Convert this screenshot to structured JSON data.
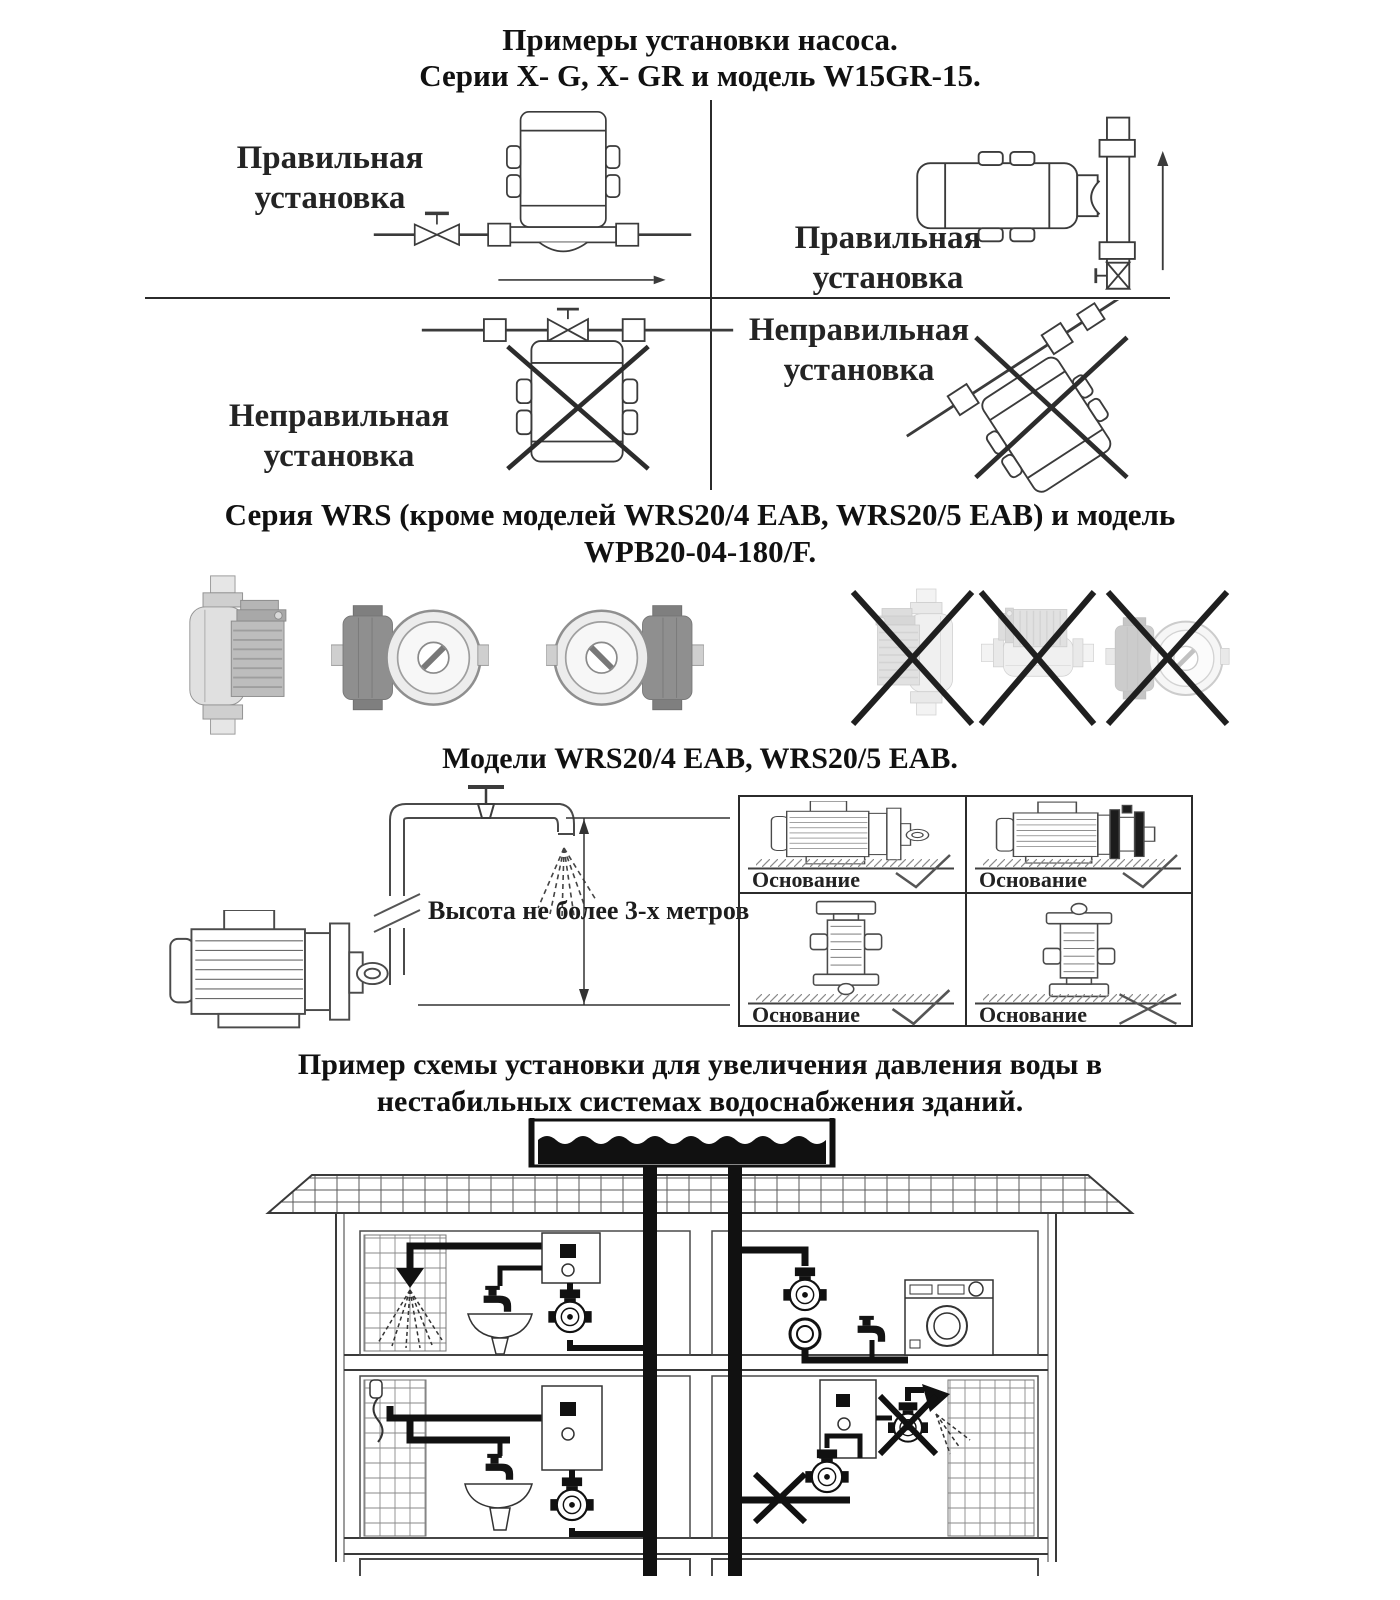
{
  "title": {
    "line1": "Примеры установки насоса.",
    "line2": "Серии X- G, X- GR и модель W15GR-15."
  },
  "xg_grid": {
    "top_left": {
      "label": "Правильная установка",
      "status": "correct"
    },
    "top_right": {
      "label": "Правильная установка",
      "status": "correct"
    },
    "bottom_left": {
      "label": "Неправильная установка",
      "status": "incorrect"
    },
    "bottom_right": {
      "label": "Неправильная установка",
      "status": "incorrect"
    }
  },
  "wrs_heading": {
    "line1": "Серия WRS (кроме моделей WRS20/4 EAB, WRS20/5 EAB) и модель",
    "line2": "WPB20-04-180/F."
  },
  "eab_heading": "Модели WRS20/4 EAB, WRS20/5 EAB.",
  "height_note": "Высота не более 3-х метров",
  "base_panels": [
    {
      "label": "Основание",
      "mark": "check"
    },
    {
      "label": "Основание",
      "mark": "check"
    },
    {
      "label": "Основание",
      "mark": "check"
    },
    {
      "label": "Основание",
      "mark": "cross"
    }
  ],
  "scheme_heading": {
    "line1": "Пример схемы установки для увеличения давления воды в",
    "line2": "нестабильных системах водоснабжения зданий."
  },
  "colors": {
    "ink": "#1c1c1c",
    "line": "#2b2b2b",
    "gray_pump": "#bdbdbd"
  }
}
